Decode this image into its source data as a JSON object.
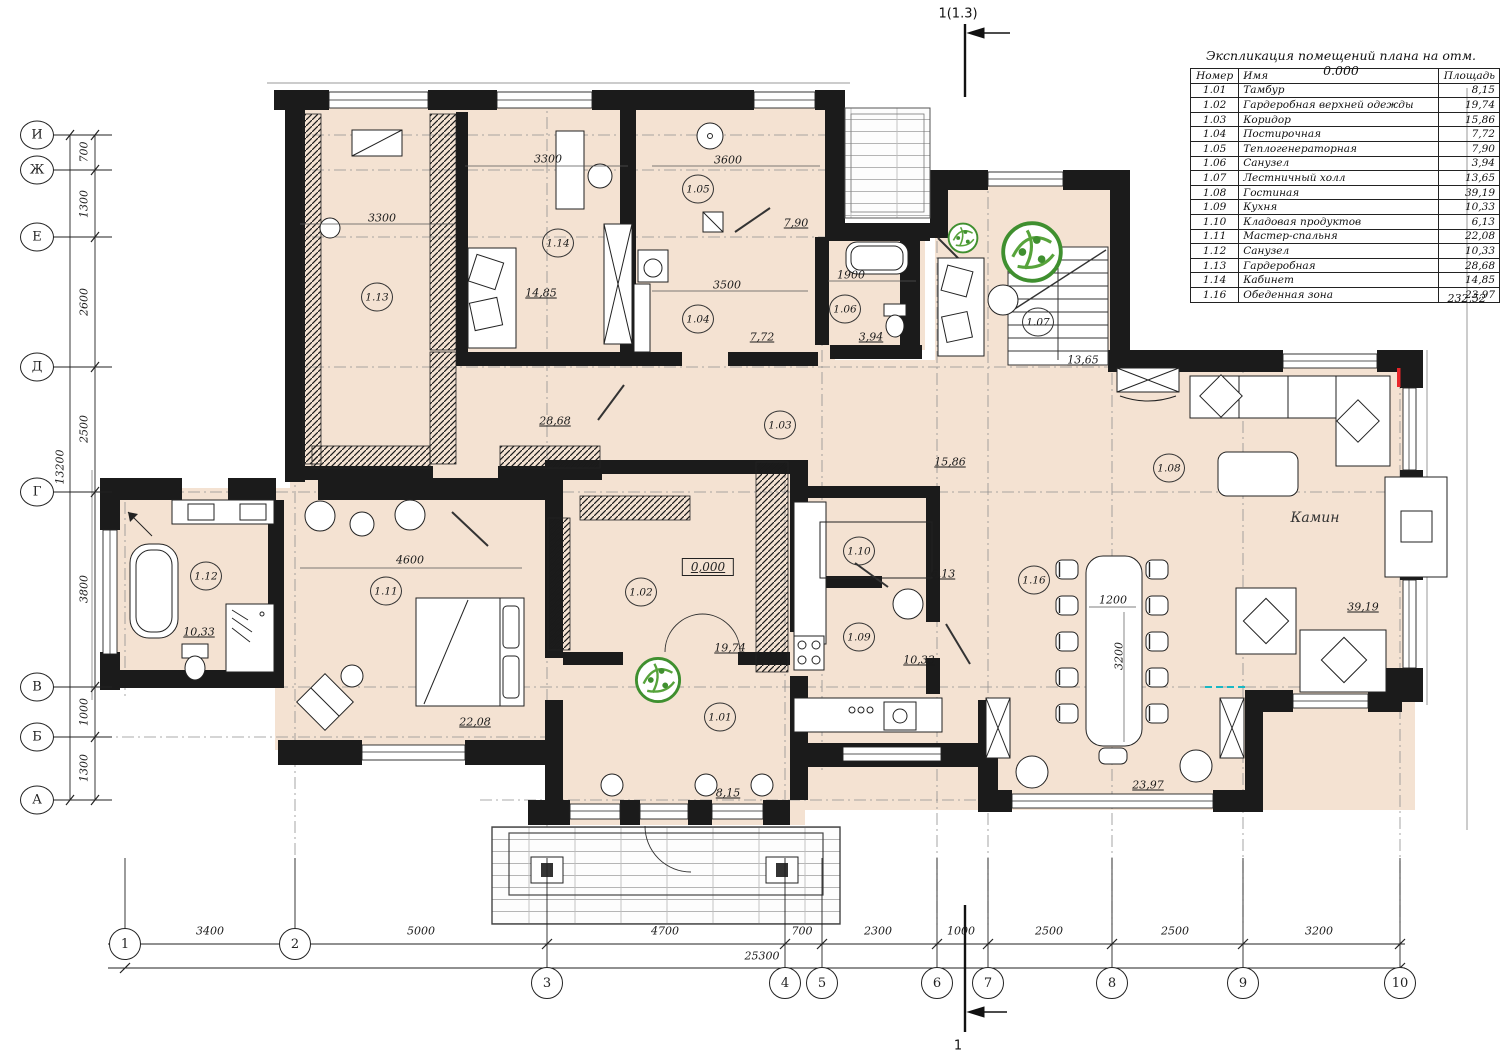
{
  "drawing": {
    "floor_color": "#f4e2d2",
    "wall_color": "#1b1b1b",
    "plant_color": "#3f8f2f",
    "accent_red": "#e8262a",
    "accent_cyan": "#19b8c4"
  },
  "section_markers": {
    "top": {
      "label": "1(1.3)",
      "x": 958,
      "y": 14
    },
    "bottom": {
      "label": "1",
      "x": 958,
      "y": 1046
    }
  },
  "legend": {
    "title": "Экспликация помещений плана на отм. 0.000",
    "headers": [
      "Номер",
      "Имя",
      "Площадь"
    ],
    "rows": [
      [
        "1.01",
        "Тамбур",
        "8,15"
      ],
      [
        "1.02",
        "Гардеробная верхней одежды",
        "19,74"
      ],
      [
        "1.03",
        "Коридор",
        "15,86"
      ],
      [
        "1.04",
        "Постирочная",
        "7,72"
      ],
      [
        "1.05",
        "Теплогенераторная",
        "7,90"
      ],
      [
        "1.06",
        "Санузел",
        "3,94"
      ],
      [
        "1.07",
        "Лестничный холл",
        "13,65"
      ],
      [
        "1.08",
        "Гостиная",
        "39,19"
      ],
      [
        "1.09",
        "Кухня",
        "10,33"
      ],
      [
        "1.10",
        "Кладовая продуктов",
        "6,13"
      ],
      [
        "1.11",
        "Мастер-спальня",
        "22,08"
      ],
      [
        "1.12",
        "Санузел",
        "10,33"
      ],
      [
        "1.13",
        "Гардеробная",
        "28,68"
      ],
      [
        "1.14",
        "Кабинет",
        "14,85"
      ],
      [
        "1.16",
        "Обеденная зона",
        "23,97"
      ]
    ],
    "total": "232,52"
  },
  "axes": {
    "rows": [
      {
        "label": "И",
        "y": 135
      },
      {
        "label": "Ж",
        "y": 170
      },
      {
        "label": "Е",
        "y": 237
      },
      {
        "label": "Д",
        "y": 367
      },
      {
        "label": "Г",
        "y": 492
      },
      {
        "label": "В",
        "y": 687
      },
      {
        "label": "Б",
        "y": 737
      },
      {
        "label": "А",
        "y": 800
      }
    ],
    "cols": [
      {
        "label": "1",
        "x": 125,
        "row": 1
      },
      {
        "label": "2",
        "x": 295,
        "row": 1
      },
      {
        "label": "3",
        "x": 547,
        "row": 2
      },
      {
        "label": "4",
        "x": 785,
        "row": 2
      },
      {
        "label": "5",
        "x": 822,
        "row": 2
      },
      {
        "label": "6",
        "x": 937,
        "row": 2
      },
      {
        "label": "7",
        "x": 988,
        "row": 2
      },
      {
        "label": "8",
        "x": 1112,
        "row": 2
      },
      {
        "label": "9",
        "x": 1243,
        "row": 2
      },
      {
        "label": "10",
        "x": 1400,
        "row": 2
      }
    ]
  },
  "dims": {
    "left_segments": [
      {
        "text": "700",
        "y": 152
      },
      {
        "text": "1300",
        "y": 204
      },
      {
        "text": "2600",
        "y": 302
      },
      {
        "text": "2500",
        "y": 429
      },
      {
        "text": "3800",
        "y": 589
      },
      {
        "text": "1000",
        "y": 712
      },
      {
        "text": "1300",
        "y": 768
      }
    ],
    "left_total": {
      "text": "13200",
      "y": 467
    },
    "bottom_segments": [
      {
        "text": "3400",
        "x": 210
      },
      {
        "text": "5000",
        "x": 421
      },
      {
        "text": "4700",
        "x": 665
      },
      {
        "text": "700",
        "x": 802
      },
      {
        "text": "2300",
        "x": 878
      },
      {
        "text": "1000",
        "x": 961
      },
      {
        "text": "2500",
        "x": 1049
      },
      {
        "text": "2500",
        "x": 1175
      },
      {
        "text": "3200",
        "x": 1319
      }
    ],
    "bottom_total": {
      "text": "25300",
      "x": 762
    }
  },
  "rooms": [
    {
      "number": "1.01",
      "area": "8,15",
      "cx": 720,
      "cy": 717,
      "ax": 728,
      "ay": 793
    },
    {
      "number": "1.02",
      "area": "19,74",
      "cx": 641,
      "cy": 592,
      "ax": 730,
      "ay": 648
    },
    {
      "number": "1.03",
      "area": "15,86",
      "cx": 780,
      "cy": 425,
      "ax": 950,
      "ay": 462
    },
    {
      "number": "1.04",
      "area": "7,72",
      "cx": 698,
      "cy": 319,
      "ax": 762,
      "ay": 337
    },
    {
      "number": "1.05",
      "area": "7,90",
      "cx": 698,
      "cy": 189,
      "ax": 796,
      "ay": 223
    },
    {
      "number": "1.06",
      "area": "3,94",
      "cx": 845,
      "cy": 309,
      "ax": 871,
      "ay": 337
    },
    {
      "number": "1.07",
      "area": "13,65",
      "cx": 1038,
      "cy": 322,
      "ax": 1083,
      "ay": 360
    },
    {
      "number": "1.08",
      "area": "39,19",
      "cx": 1169,
      "cy": 468,
      "ax": 1363,
      "ay": 607
    },
    {
      "number": "1.09",
      "area": "10,33",
      "cx": 859,
      "cy": 637,
      "ax": 919,
      "ay": 660
    },
    {
      "number": "1.10",
      "area": "6,13",
      "cx": 859,
      "cy": 551,
      "ax": 943,
      "ay": 574
    },
    {
      "number": "1.11",
      "area": "22,08",
      "cx": 386,
      "cy": 591,
      "ax": 475,
      "ay": 722
    },
    {
      "number": "1.12",
      "area": "10,33",
      "cx": 206,
      "cy": 576,
      "ax": 199,
      "ay": 632
    },
    {
      "number": "1.13",
      "area": "28,68",
      "cx": 377,
      "cy": 297,
      "ax": 555,
      "ay": 421
    },
    {
      "number": "1.14",
      "area": "14,85",
      "cx": 558,
      "cy": 243,
      "ax": 541,
      "ay": 293
    },
    {
      "number": "1.16",
      "area": "23,97",
      "cx": 1034,
      "cy": 580,
      "ax": 1148,
      "ay": 785
    }
  ],
  "inline_dims": [
    {
      "text": "3300",
      "x": 382,
      "y": 218,
      "rot": 0
    },
    {
      "text": "3300",
      "x": 548,
      "y": 159,
      "rot": 0
    },
    {
      "text": "3600",
      "x": 728,
      "y": 160,
      "rot": 0
    },
    {
      "text": "3500",
      "x": 727,
      "y": 285,
      "rot": 0
    },
    {
      "text": "1900",
      "x": 851,
      "y": 275,
      "rot": 0
    },
    {
      "text": "4600",
      "x": 410,
      "y": 560,
      "rot": 0
    },
    {
      "text": "1200",
      "x": 1113,
      "y": 600,
      "rot": 0
    },
    {
      "text": "3200",
      "x": 1119,
      "y": 656,
      "rot": 90
    }
  ],
  "annotations": [
    {
      "text": "Камин",
      "x": 1315,
      "y": 518
    }
  ],
  "level_mark": {
    "text": "0,000",
    "x": 708,
    "y": 567
  }
}
